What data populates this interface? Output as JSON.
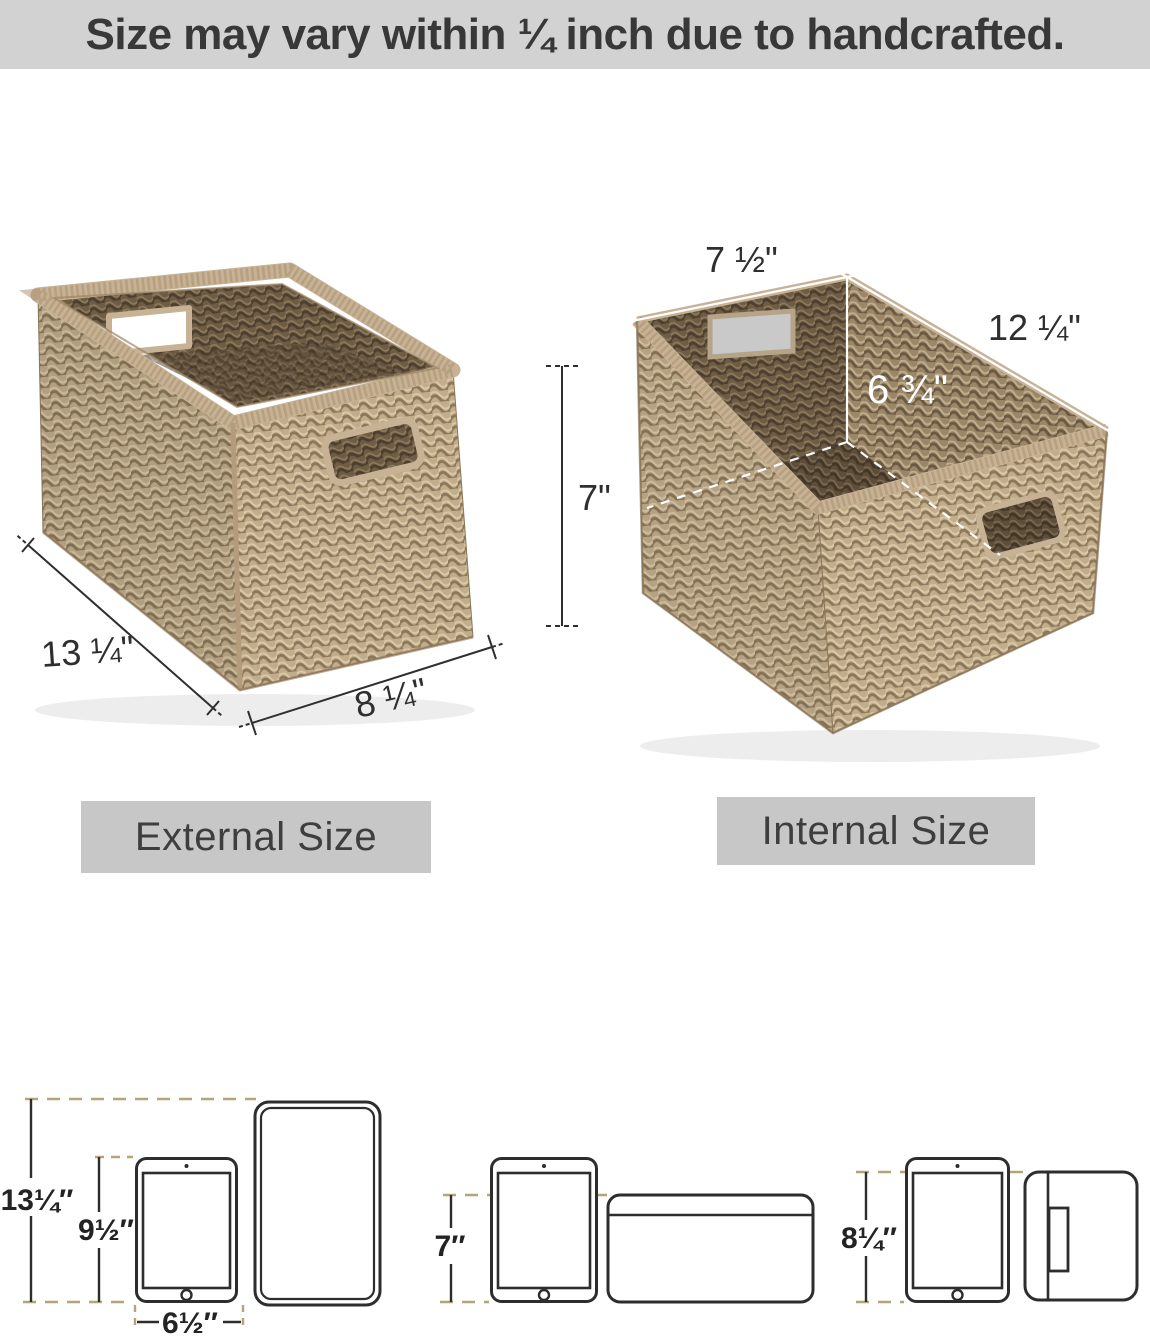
{
  "header": {
    "text": "Size may vary within ¼ inch due to handcrafted."
  },
  "external_view": {
    "label": "External Size",
    "length_label": "13 ¼\"",
    "width_label": "8 ¼\"",
    "height_label": "7\""
  },
  "internal_view": {
    "label": "Internal Size",
    "width_label": "7 ½\"",
    "length_label": "12 ¼\"",
    "depth_label": "6 ¾\""
  },
  "size_comparison": {
    "left": {
      "overall_height": "13¼″",
      "tablet_height": "9½″",
      "tablet_width": "6½″"
    },
    "middle": {
      "basket_height": "7″"
    },
    "right": {
      "basket_height": "8¼″"
    }
  },
  "colors": {
    "banner_bg": "#d2d2d2",
    "banner_text": "#383838",
    "size_tag_bg": "#c7c7c7",
    "size_tag_text": "#3e3e3e",
    "dimension_line": "#2f2f2f",
    "dashed_extension": "#b5a478",
    "internal_line": "#ffffff",
    "weave_light": "#c2ad8b",
    "weave_dark": "#6e5c44",
    "rim": "#c7b295"
  }
}
